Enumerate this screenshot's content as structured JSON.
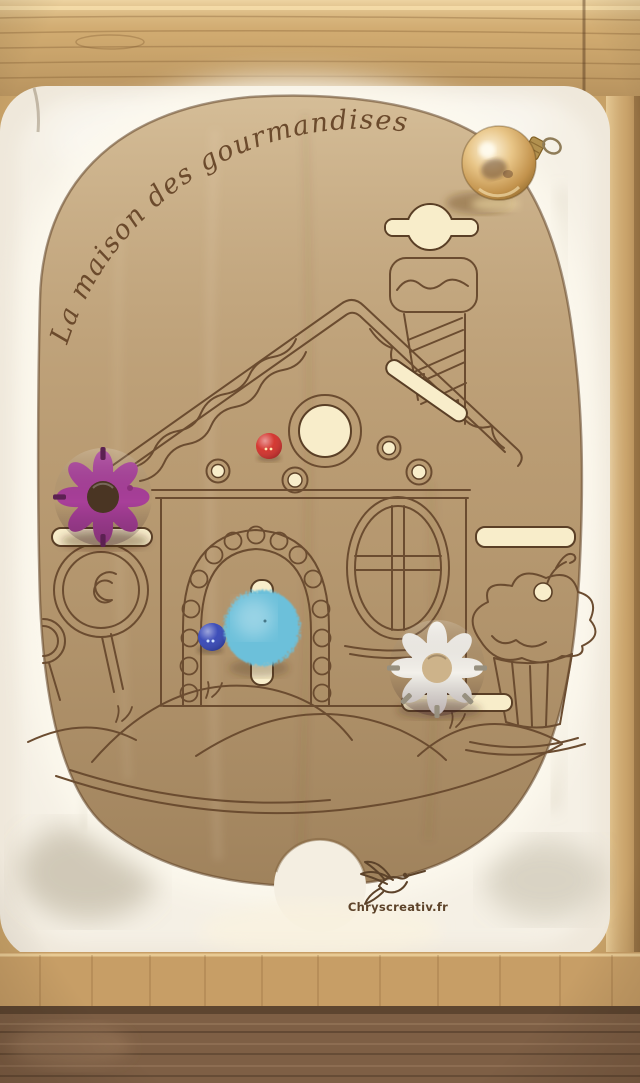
{
  "board": {
    "title": "La maison des gourmandises",
    "logo_text": "Chryscreativ.fr"
  },
  "pieces": {
    "gold_ball": {
      "label": "gold ornament ball",
      "color": "#d7ab62"
    },
    "purple_knob": {
      "label": "purple flower knob",
      "color": "#a83f99"
    },
    "white_knob": {
      "label": "white flower knob",
      "color": "#f3f0ea"
    },
    "pompom": {
      "label": "blue pompom",
      "color": "#6cc0da"
    },
    "blue_bead": {
      "label": "blue bead",
      "color": "#2336b0"
    },
    "red_bead": {
      "label": "red bead",
      "color": "#cf1d16"
    }
  },
  "materials": {
    "board_wood": "#b79970",
    "engraving_brown": "#6b4c30",
    "slot_glow": "#f8edca",
    "bin_plastic": "#efe8db",
    "frame_wood": "#d3ae74"
  }
}
